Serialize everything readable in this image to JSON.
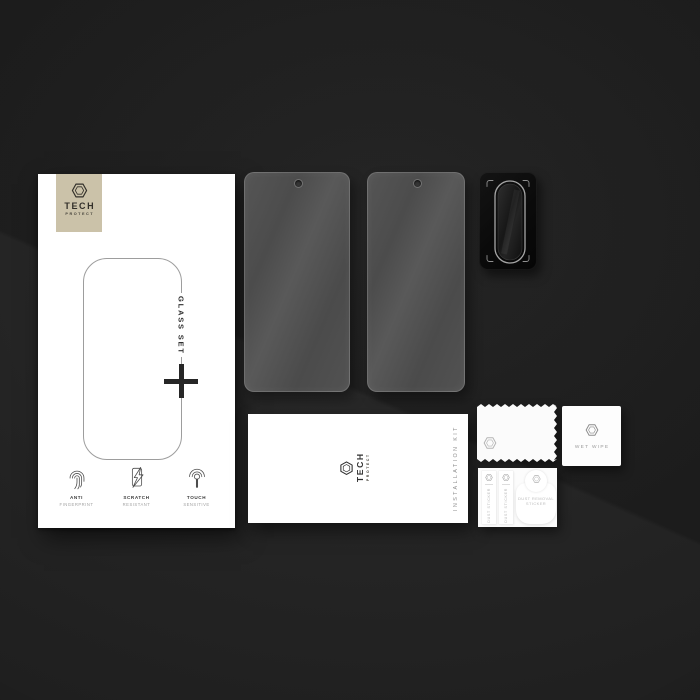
{
  "brand": {
    "top": "TECH",
    "bottom": "PROTECT"
  },
  "colors": {
    "background": "#1d1d1d",
    "box_white": "#ffffff",
    "badge_beige": "#cbc2a9",
    "glass_gray": "#4f4f4f",
    "protector_black": "#0b0b0b",
    "accent_text_dark": "#2e2e2e",
    "muted_text": "#9a9a9a"
  },
  "main_box": {
    "set_label": "GLASS SET",
    "features": [
      {
        "icon": "fingerprint-icon",
        "line1": "ANTI",
        "line2": "FINGERPRINT"
      },
      {
        "icon": "phone-lightning-icon",
        "line1": "SCRATCH",
        "line2": "RESISTANT"
      },
      {
        "icon": "touch-icon",
        "line1": "TOUCH",
        "line2": "SENSITIVE"
      }
    ]
  },
  "kit_box": {
    "side_label": "INSTALLATION KIT"
  },
  "wet_wipe": {
    "label": "WET WIPE"
  },
  "sticker_card": {
    "strips": [
      {
        "label": "DUST STICKER"
      },
      {
        "label": "DUST STICKER"
      }
    ],
    "drop": {
      "line1": "DUST REMOVAL",
      "line2": "STICKER"
    }
  },
  "icons": [
    "brand-hexagon-icon",
    "fingerprint-icon",
    "phone-lightning-icon",
    "touch-icon"
  ]
}
